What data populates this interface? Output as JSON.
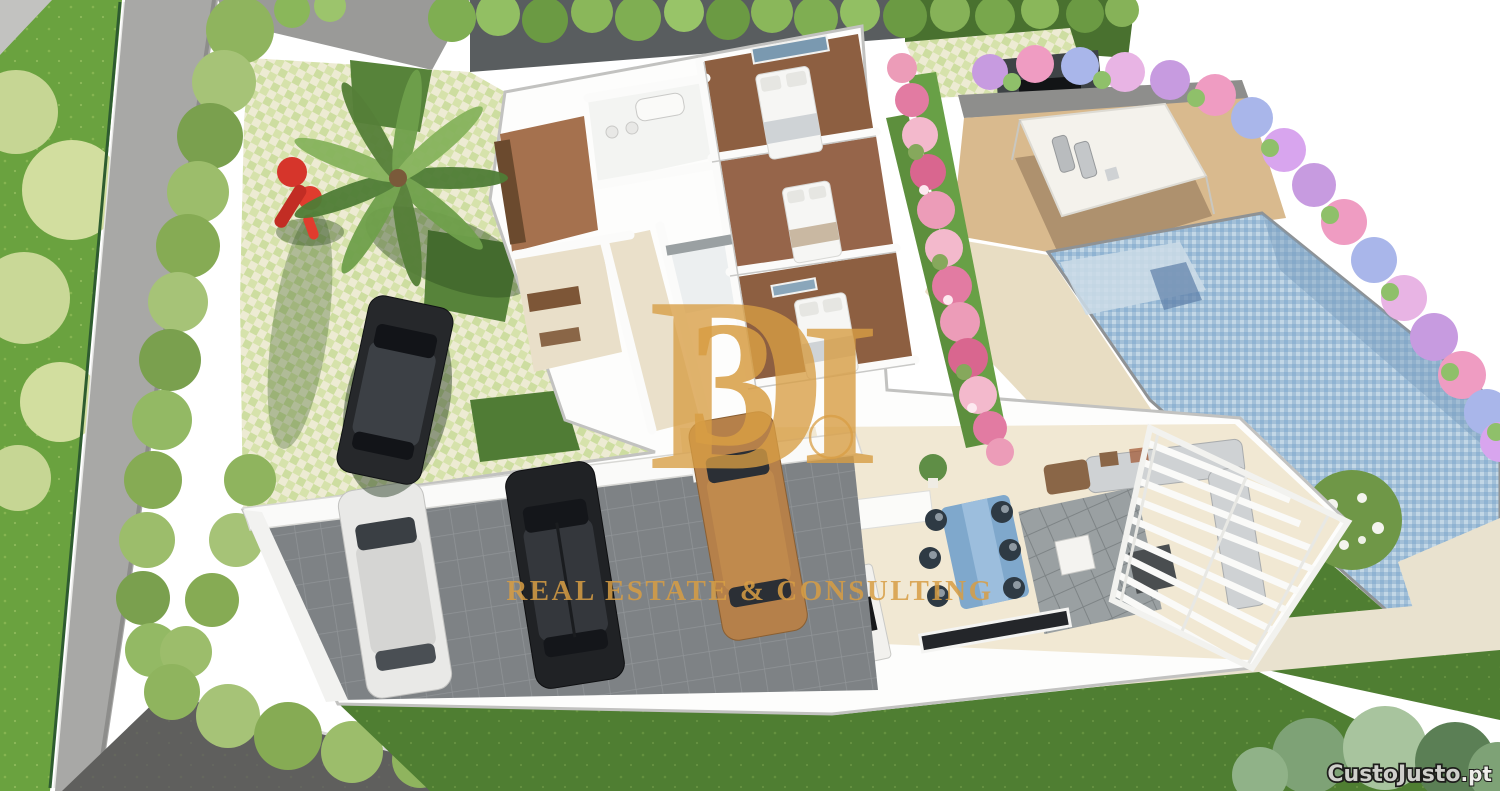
{
  "meta": {
    "kind": "3D aerial architectural render",
    "subject": "Cutaway floor plan of a single-storey villa with garden, carport, sand terrace and swimming pool"
  },
  "watermark": {
    "monogram_d": "D",
    "monogram_3": "3",
    "monogram_bar": "I",
    "tagline": "REAL ESTATE & CONSULTING",
    "color": "#d89e44"
  },
  "footer_watermark": {
    "brand": "CustoJusto",
    "tld": ".pt"
  },
  "scene": {
    "areas": [
      "street-lawn-with-shrubs",
      "perimeter-wall",
      "boundary-hedge",
      "paver-driveway-garden",
      "palm-tree",
      "red-playground-slide",
      "parked-car-driveway",
      "villa-cutaway-floorplan",
      "bedrooms-with-wood-floors",
      "bathrooms",
      "hallway",
      "closet-room",
      "office-room",
      "kitchen-island",
      "dining-set-blue",
      "living-room-sofa-rug",
      "louvered-pergola",
      "carport-three-cars",
      "sand-sunbathing-terrace",
      "shade-sail-with-loungers",
      "swimming-pool",
      "hydrangea-flower-border",
      "rose-hedge",
      "rear-lawn",
      "garden-paths",
      "flowering-bush",
      "garden-shrubs"
    ],
    "palette": {
      "lawn_bright": "#6aa23f",
      "lawn_dark": "#4f7e32",
      "hedge_green": "#8fb45e",
      "wall_gray": "#a8a8a6",
      "dark_wall": "#595d5f",
      "paver_checker_a": "#d6e2ab",
      "paver_checker_b": "#edebd3",
      "sand_terrace": "#d9ba8e",
      "walkway": "#e8ddc3",
      "pool_water": "#a3c0d8",
      "flower_pink": "#ec9db9",
      "flower_purple": "#b591dc",
      "house_white": "#fdfdfc",
      "wood_floor": "#8d5f41",
      "floor_beige": "#eae0ca",
      "carport_tile": "#7e8285",
      "car_white": "#e9e9e7",
      "car_black": "#202225",
      "car_gold": "#b5804a",
      "playground_red": "#d6352b",
      "watermark_gold": "#d89e44"
    }
  }
}
